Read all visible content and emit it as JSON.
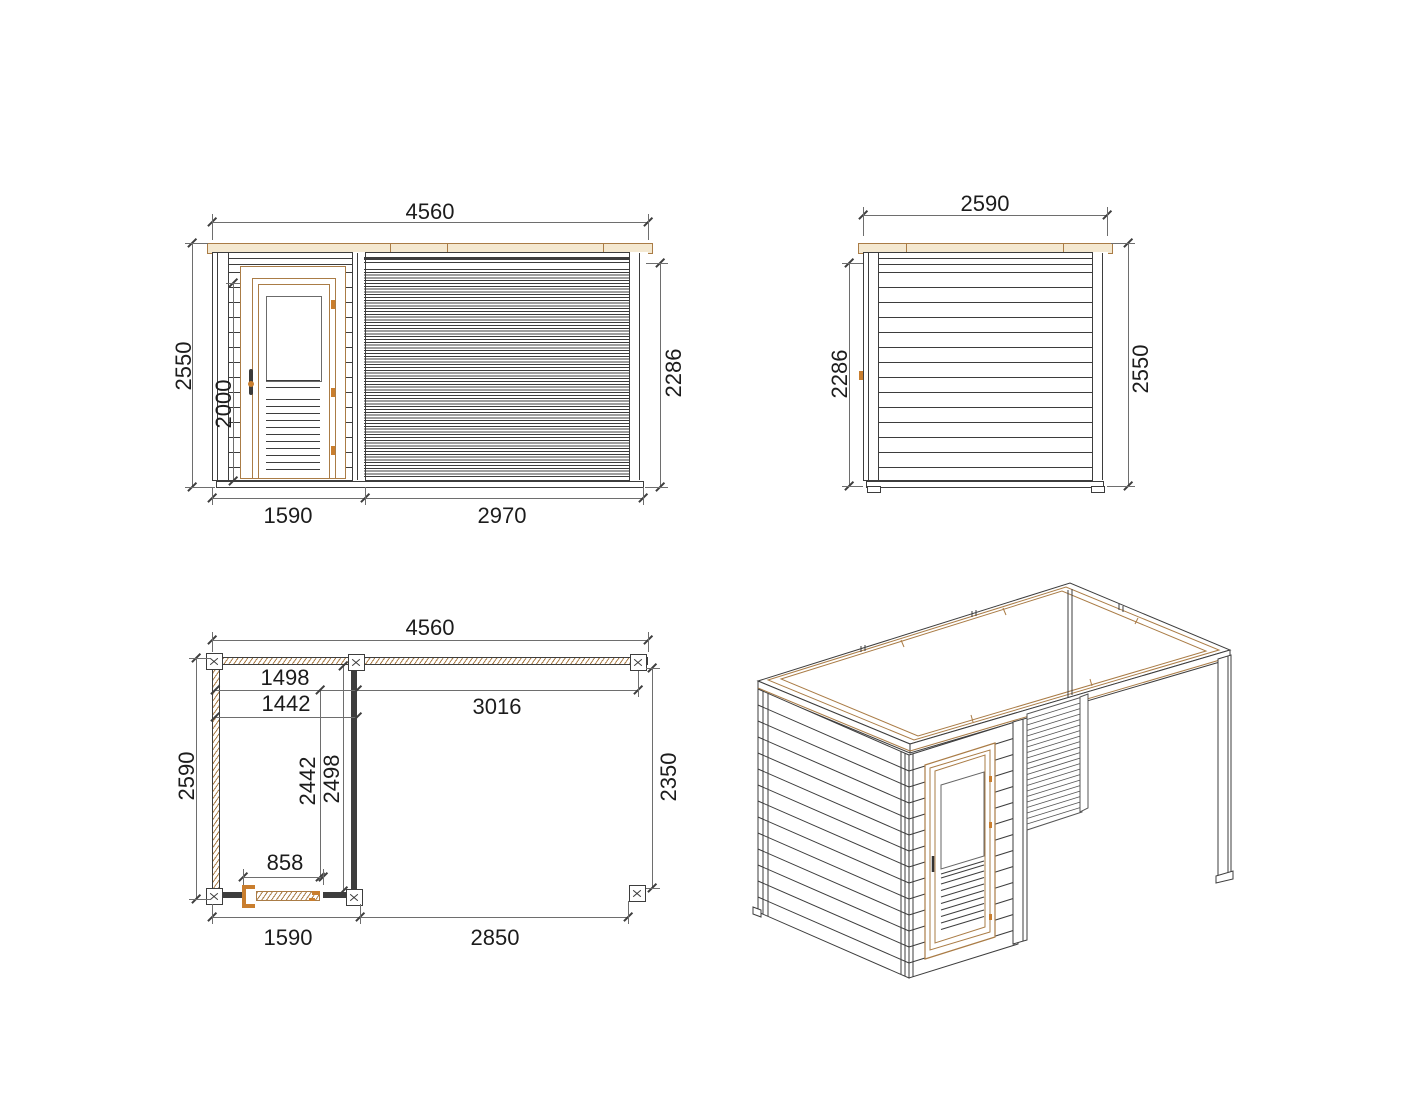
{
  "drawing": {
    "views": {
      "front_elevation": {
        "label": "front-elevation",
        "dims": {
          "overall_width": "4560",
          "overall_height": "2550",
          "door_height": "2000",
          "wall_height": "2286",
          "cabin_width": "1590",
          "louver_wall_width": "2970"
        }
      },
      "side_elevation": {
        "label": "side-elevation",
        "dims": {
          "depth": "2590",
          "wall_height": "2286",
          "overall_height": "2550"
        }
      },
      "floor_plan": {
        "label": "floor-plan",
        "dims": {
          "overall_width": "4560",
          "cabin_inner_width": "1498",
          "cabin_clear_width": "1442",
          "canopy_span": "3016",
          "overall_depth": "2590",
          "cabin_inner_depth": "2442",
          "cabin_clear_depth": "2498",
          "canopy_depth": "2350",
          "door_opening": "858",
          "cabin_width": "1590",
          "canopy_width": "2850"
        }
      },
      "isometric": {
        "label": "isometric-view"
      }
    },
    "colors": {
      "line": "#3d3d3d",
      "dim_line": "#6e6e6e",
      "text": "#1c1c1c",
      "wood_fill": "#f4e8d0",
      "wood_line": "#aa7c46",
      "hardware_orange": "#c97e2e",
      "background": "#ffffff"
    }
  }
}
